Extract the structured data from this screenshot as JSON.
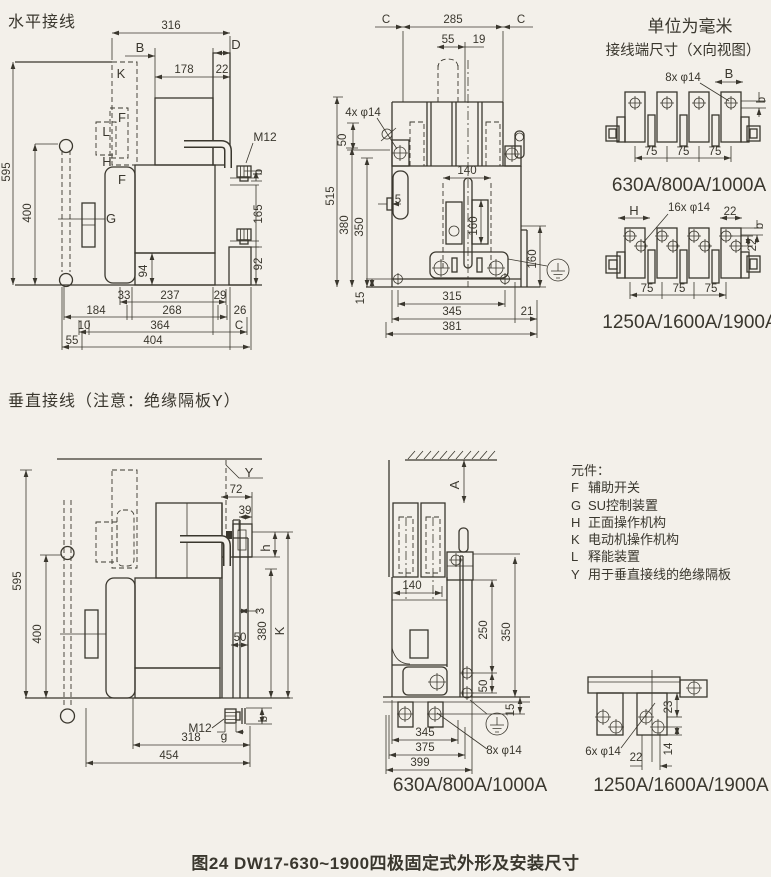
{
  "meta": {
    "bg": "#f3f0ea",
    "ink": "#3a372e"
  },
  "titles": {
    "horizontal_section": "水平接线",
    "vertical_section": "垂直接线（注意：绝缘隔板Y）",
    "units_note": "单位为毫米",
    "terminal_note": "接线端尺寸（X向视图）",
    "caption": "图24 DW17-630~1900四极固定式外形及安装尺寸"
  },
  "legend": {
    "title": "元件：",
    "items": [
      {
        "key": "F",
        "label": "辅助开关"
      },
      {
        "key": "G",
        "label": "SU控制装置"
      },
      {
        "key": "H",
        "label": "正面操作机构"
      },
      {
        "key": "K",
        "label": "电动机操作机构"
      },
      {
        "key": "L",
        "label": "释能装置"
      },
      {
        "key": "Y",
        "label": "用于垂直接线的绝缘隔板"
      }
    ]
  },
  "labels": [
    {
      "t": "316",
      "x": 171,
      "y": 29
    },
    {
      "t": "B",
      "x": 140,
      "y": 52,
      "fs": 13
    },
    {
      "t": "D",
      "x": 236,
      "y": 49,
      "fs": 13
    },
    {
      "t": "178",
      "x": 184,
      "y": 73
    },
    {
      "t": "22",
      "x": 222,
      "y": 73
    },
    {
      "t": "K",
      "x": 121,
      "y": 78,
      "fs": 13
    },
    {
      "t": "F",
      "x": 122,
      "y": 122,
      "fs": 13
    },
    {
      "t": "L",
      "x": 106,
      "y": 136,
      "fs": 13
    },
    {
      "t": "H",
      "x": 107,
      "y": 166,
      "fs": 13
    },
    {
      "t": "F",
      "x": 122,
      "y": 184,
      "fs": 13
    },
    {
      "t": "G",
      "x": 111,
      "y": 223,
      "fs": 13
    },
    {
      "t": "M12",
      "x": 265,
      "y": 141,
      "fs": 12
    },
    {
      "t": "595",
      "x": 10,
      "y": 172,
      "r": -90
    },
    {
      "t": "400",
      "x": 31,
      "y": 213,
      "r": -90
    },
    {
      "t": "94",
      "x": 147,
      "y": 271,
      "r": -90
    },
    {
      "t": "b",
      "x": 262,
      "y": 172,
      "r": -90
    },
    {
      "t": "165",
      "x": 262,
      "y": 214,
      "r": -90
    },
    {
      "t": "92",
      "x": 262,
      "y": 264,
      "r": -90
    },
    {
      "t": "33",
      "x": 124,
      "y": 299
    },
    {
      "t": "237",
      "x": 170,
      "y": 299
    },
    {
      "t": "29",
      "x": 220,
      "y": 299
    },
    {
      "t": "184",
      "x": 96,
      "y": 314
    },
    {
      "t": "268",
      "x": 172,
      "y": 314
    },
    {
      "t": "26",
      "x": 240,
      "y": 314
    },
    {
      "t": "10",
      "x": 84,
      "y": 329
    },
    {
      "t": "364",
      "x": 160,
      "y": 329
    },
    {
      "t": "C",
      "x": 239,
      "y": 329
    },
    {
      "t": "55",
      "x": 72,
      "y": 344
    },
    {
      "t": "404",
      "x": 153,
      "y": 344
    },
    {
      "t": "C",
      "x": 386,
      "y": 23
    },
    {
      "t": "285",
      "x": 453,
      "y": 23
    },
    {
      "t": "C",
      "x": 521,
      "y": 23
    },
    {
      "t": "55",
      "x": 448,
      "y": 43
    },
    {
      "t": "19",
      "x": 479,
      "y": 43
    },
    {
      "t": "4x φ14",
      "x": 363,
      "y": 116
    },
    {
      "t": "50",
      "x": 346,
      "y": 140,
      "r": -90
    },
    {
      "t": "515",
      "x": 334,
      "y": 196,
      "r": -90
    },
    {
      "t": "380",
      "x": 348,
      "y": 225,
      "r": -90
    },
    {
      "t": "350",
      "x": 363,
      "y": 227,
      "r": -90
    },
    {
      "t": "5",
      "x": 398,
      "y": 203
    },
    {
      "t": "140",
      "x": 467,
      "y": 174
    },
    {
      "t": "160",
      "x": 477,
      "y": 226,
      "r": -90
    },
    {
      "t": "160",
      "x": 536,
      "y": 259,
      "r": -90
    },
    {
      "t": "15",
      "x": 364,
      "y": 298,
      "r": -90
    },
    {
      "t": "315",
      "x": 452,
      "y": 300
    },
    {
      "t": "345",
      "x": 452,
      "y": 315
    },
    {
      "t": "21",
      "x": 527,
      "y": 315
    },
    {
      "t": "381",
      "x": 452,
      "y": 330
    },
    {
      "t": "8x φ14",
      "x": 683,
      "y": 81
    },
    {
      "t": "B",
      "x": 729,
      "y": 78,
      "fs": 13
    },
    {
      "t": "b",
      "x": 765,
      "y": 100,
      "r": -90
    },
    {
      "t": "75",
      "x": 651,
      "y": 155
    },
    {
      "t": "75",
      "x": 683,
      "y": 155
    },
    {
      "t": "75",
      "x": 715,
      "y": 155
    },
    {
      "t": "630A/800A/1000A",
      "x": 689,
      "y": 191,
      "fs": 19
    },
    {
      "t": "H",
      "x": 634,
      "y": 215,
      "fs": 13
    },
    {
      "t": "16x φ14",
      "x": 689,
      "y": 211
    },
    {
      "t": "22",
      "x": 730,
      "y": 215
    },
    {
      "t": "b",
      "x": 763,
      "y": 226,
      "r": -90
    },
    {
      "t": "22",
      "x": 756,
      "y": 245,
      "r": -90
    },
    {
      "t": "75",
      "x": 647,
      "y": 292
    },
    {
      "t": "75",
      "x": 679,
      "y": 292
    },
    {
      "t": "75",
      "x": 711,
      "y": 292
    },
    {
      "t": "1250A/1600A/1900A",
      "x": 690,
      "y": 328,
      "fs": 19
    },
    {
      "t": "Y",
      "x": 249,
      "y": 477,
      "fs": 13
    },
    {
      "t": "72",
      "x": 236,
      "y": 493
    },
    {
      "t": "39",
      "x": 245,
      "y": 514
    },
    {
      "t": "h",
      "x": 270,
      "y": 548,
      "r": -90,
      "fs": 13
    },
    {
      "t": "595",
      "x": 21,
      "y": 581,
      "r": -90
    },
    {
      "t": "400",
      "x": 41,
      "y": 634,
      "r": -90
    },
    {
      "t": "3",
      "x": 264,
      "y": 611,
      "r": -90
    },
    {
      "t": "380",
      "x": 266,
      "y": 631,
      "r": -90
    },
    {
      "t": "K",
      "x": 284,
      "y": 631,
      "r": -90,
      "fs": 13
    },
    {
      "t": "50",
      "x": 240,
      "y": 641
    },
    {
      "t": "M12",
      "x": 200,
      "y": 732,
      "fs": 12
    },
    {
      "t": "g",
      "x": 224,
      "y": 740,
      "fs": 12
    },
    {
      "t": "b",
      "x": 267,
      "y": 719,
      "r": -90
    },
    {
      "t": "318",
      "x": 191,
      "y": 741
    },
    {
      "t": "454",
      "x": 169,
      "y": 759
    },
    {
      "t": "A",
      "x": 459,
      "y": 485,
      "r": -90,
      "fs": 13
    },
    {
      "t": "140",
      "x": 412,
      "y": 589
    },
    {
      "t": "250",
      "x": 487,
      "y": 630,
      "r": -90
    },
    {
      "t": "350",
      "x": 510,
      "y": 632,
      "r": -90
    },
    {
      "t": "50",
      "x": 487,
      "y": 686,
      "r": -90
    },
    {
      "t": "15",
      "x": 514,
      "y": 710,
      "r": -90
    },
    {
      "t": "345",
      "x": 425,
      "y": 736
    },
    {
      "t": "375",
      "x": 425,
      "y": 751
    },
    {
      "t": "399",
      "x": 420,
      "y": 766
    },
    {
      "t": "8x φ14",
      "x": 504,
      "y": 754
    },
    {
      "t": "630A/800A/1000A",
      "x": 470,
      "y": 791,
      "fs": 19
    },
    {
      "t": "23",
      "x": 672,
      "y": 707,
      "r": -90
    },
    {
      "t": "14",
      "x": 672,
      "y": 749,
      "r": -90
    },
    {
      "t": "6x φ14",
      "x": 603,
      "y": 755
    },
    {
      "t": "22",
      "x": 636,
      "y": 761
    },
    {
      "t": "1250A/1600A/1900A",
      "x": 681,
      "y": 791,
      "fs": 19
    }
  ]
}
